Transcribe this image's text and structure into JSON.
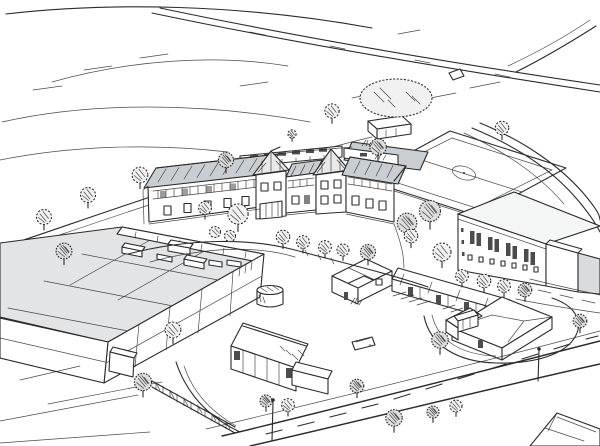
{
  "scene": {
    "title": "Aerial artist's-impression sketch of a school campus",
    "medium": "black ink line sketch with grey roof shading on white paper",
    "colors": {
      "paper": "#ffffff",
      "ink": "#2b2b2b",
      "roof": "#c9ced2",
      "panel": "#e2e4e6",
      "shade": "#d9dbdd",
      "window": "#4c4c4c",
      "crown": "#f1f1f1"
    },
    "objects": {
      "background": [
        "rolling open fields drawn with sparse contour strokes",
        "approach road crossing the top right with a fork to the corner",
        "small roadside sign"
      ],
      "campus_buildings": [
        "two-storey school with grey pitched roofs and two half-timbered gables",
        "rear single-storey block with dark rooflights",
        "large flat-roofed sports hall with panelled grey roof and rooftop plant units",
        "gym block with tall glazed windows and white side extension",
        "single-storey classroom cluster and terraced row of small units",
        "hip-roofed building beside a turning loop",
        "long single-storey building with annex in the foreground",
        "small pavilion beside the sports pitch",
        "partly visible houses at the bottom right corner"
      ],
      "grounds": [
        "sports pitch with centre circle and halfway line",
        "tree-lined footpath behind the school",
        "curving courtyard paths",
        "parking bays",
        "timber fence",
        "storage tank",
        "scattered trees, bushes and grass tufts",
        "turning loop road"
      ],
      "foreground": [
        "main road with dashed centre line",
        "access path",
        "two street lamps",
        "parked car"
      ]
    }
  }
}
